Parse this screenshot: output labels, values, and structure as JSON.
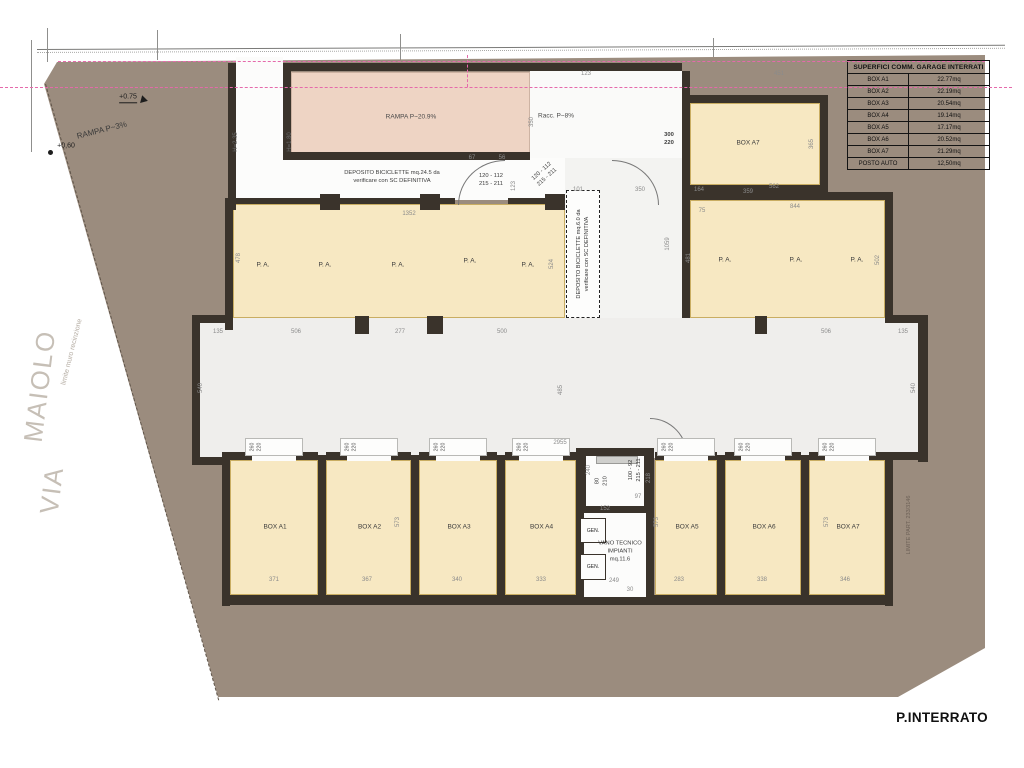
{
  "colors": {
    "site_fill": "#9b8c7e",
    "room_fill": "#f7e8c2",
    "ramp_fill": "#eed4c4",
    "wall": "#3a332b",
    "corridor_fill": "#efeeec",
    "boundary_pink": "#e569ab"
  },
  "title_block": {
    "floor_label": "P.INTERRATO"
  },
  "areas_table": {
    "header": "SUPERFICI COMM. GARAGE INTERRATI",
    "rows": [
      {
        "label": "BOX A1",
        "value": "22.77mq"
      },
      {
        "label": "BOX A2",
        "value": "22.19mq"
      },
      {
        "label": "BOX A3",
        "value": "20.54mq"
      },
      {
        "label": "BOX A4",
        "value": "19.14mq"
      },
      {
        "label": "BOX A5",
        "value": "17.17mq"
      },
      {
        "label": "BOX A6",
        "value": "20.52mq"
      },
      {
        "label": "BOX A7",
        "value": "21.29mq"
      },
      {
        "label": "POSTO AUTO",
        "value": "12,50mq"
      }
    ]
  },
  "site": {
    "street_word_top": "MAIOLO",
    "street_word_bottom": "VIA",
    "fence_label": "limite muro recinzione",
    "external_ramp_label": "RAMPA P~3%",
    "spot_height_upper": "+0.75",
    "spot_height_lower": "+0,60",
    "parcel_boundary_label": "LIMITE PART. 233/3146"
  },
  "plan": {
    "ramp_label": "RAMPA P~20.9%",
    "racc_label": "Racc. P~8%",
    "height_label_left": "H=2.35",
    "height_label_right": "H=1.80",
    "bike_storage_top": {
      "line1": "DEPOSITO BICICLETTE mq.24.5 da",
      "line2": "verificare con SC DEFINITIVA"
    },
    "bike_storage_mid": {
      "line1": "DEPOSITO BICICLETTE mq.6.0 da",
      "line2": "verificare con SC DEFINITIVA"
    },
    "door_size_a": {
      "line1": "120 - 112",
      "line2": "215 - 211"
    },
    "door_size_b": {
      "line1": "120 - 112",
      "line2": "215 - 211"
    },
    "door_size_c": {
      "line1": "100 - 92",
      "line2": "215 - 211"
    },
    "opening_size": {
      "line1": "300",
      "line2": "220"
    },
    "lift_size": {
      "line1": "80",
      "line2": "210"
    },
    "box_door_size": {
      "line1": "260",
      "line2": "220"
    },
    "tech_room": {
      "line1": "VANO TECNICO",
      "line2": "IMPIANTI",
      "line3": "mq.11.6"
    },
    "generator_label": "GEN.",
    "parking_label": "P. A.",
    "top_box_label": "BOX A7",
    "garage_boxes": [
      {
        "label": "BOX A1",
        "x": 230,
        "w": 88
      },
      {
        "label": "BOX A2",
        "x": 326,
        "w": 85
      },
      {
        "label": "BOX A3",
        "x": 419,
        "w": 78
      },
      {
        "label": "BOX A4",
        "x": 505,
        "w": 71
      },
      {
        "label": "BOX A5",
        "x": 655,
        "w": 62
      },
      {
        "label": "BOX A6",
        "x": 725,
        "w": 76
      },
      {
        "label": "BOX A7",
        "x": 809,
        "w": 76
      }
    ],
    "pa_spots_left": [
      {
        "x": 263,
        "y": 266
      },
      {
        "x": 325,
        "y": 266
      },
      {
        "x": 398,
        "y": 266
      },
      {
        "x": 470,
        "y": 262
      },
      {
        "x": 528,
        "y": 266
      }
    ],
    "pa_spots_right": [
      {
        "x": 725,
        "y": 261
      },
      {
        "x": 796,
        "y": 261
      },
      {
        "x": 857,
        "y": 261
      }
    ],
    "dimensions": [
      {
        "t": "123",
        "x": 586,
        "y": 74
      },
      {
        "t": "451",
        "x": 779,
        "y": 74
      },
      {
        "t": "350",
        "x": 532,
        "y": 122,
        "v": 1
      },
      {
        "t": "67",
        "x": 472,
        "y": 158
      },
      {
        "t": "56",
        "x": 502,
        "y": 158
      },
      {
        "t": "123",
        "x": 514,
        "y": 186,
        "v": 1
      },
      {
        "t": "101",
        "x": 578,
        "y": 190
      },
      {
        "t": "350",
        "x": 640,
        "y": 190
      },
      {
        "t": "1059",
        "x": 668,
        "y": 244,
        "v": 1
      },
      {
        "t": "1352",
        "x": 409,
        "y": 214
      },
      {
        "t": "478",
        "x": 239,
        "y": 258,
        "v": 1
      },
      {
        "t": "524",
        "x": 552,
        "y": 264,
        "v": 1
      },
      {
        "t": "164",
        "x": 699,
        "y": 190
      },
      {
        "t": "359",
        "x": 748,
        "y": 192
      },
      {
        "t": "562",
        "x": 774,
        "y": 187
      },
      {
        "t": "365",
        "x": 812,
        "y": 144,
        "v": 1
      },
      {
        "t": "75",
        "x": 702,
        "y": 211
      },
      {
        "t": "844",
        "x": 795,
        "y": 207
      },
      {
        "t": "481",
        "x": 689,
        "y": 258,
        "v": 1
      },
      {
        "t": "502",
        "x": 878,
        "y": 260,
        "v": 1
      },
      {
        "t": "135",
        "x": 218,
        "y": 332
      },
      {
        "t": "506",
        "x": 296,
        "y": 332
      },
      {
        "t": "277",
        "x": 400,
        "y": 332
      },
      {
        "t": "500",
        "x": 502,
        "y": 332
      },
      {
        "t": "506",
        "x": 826,
        "y": 332
      },
      {
        "t": "135",
        "x": 903,
        "y": 332
      },
      {
        "t": "540",
        "x": 201,
        "y": 388,
        "v": 1
      },
      {
        "t": "485",
        "x": 561,
        "y": 390,
        "v": 1
      },
      {
        "t": "540",
        "x": 914,
        "y": 388,
        "v": 1
      },
      {
        "t": "2955",
        "x": 560,
        "y": 443
      },
      {
        "t": "240",
        "x": 589,
        "y": 470,
        "v": 1
      },
      {
        "t": "218",
        "x": 649,
        "y": 478,
        "v": 1
      },
      {
        "t": "573",
        "x": 398,
        "y": 522,
        "v": 1
      },
      {
        "t": "573",
        "x": 657,
        "y": 522,
        "v": 1
      },
      {
        "t": "573",
        "x": 827,
        "y": 522,
        "v": 1
      },
      {
        "t": "152",
        "x": 605,
        "y": 509
      },
      {
        "t": "97",
        "x": 638,
        "y": 497
      },
      {
        "t": "371",
        "x": 274,
        "y": 580
      },
      {
        "t": "367",
        "x": 367,
        "y": 580
      },
      {
        "t": "340",
        "x": 457,
        "y": 580
      },
      {
        "t": "333",
        "x": 541,
        "y": 580
      },
      {
        "t": "249",
        "x": 614,
        "y": 581
      },
      {
        "t": "283",
        "x": 679,
        "y": 580
      },
      {
        "t": "338",
        "x": 762,
        "y": 580
      },
      {
        "t": "346",
        "x": 845,
        "y": 580
      },
      {
        "t": "30",
        "x": 630,
        "y": 590
      }
    ]
  }
}
